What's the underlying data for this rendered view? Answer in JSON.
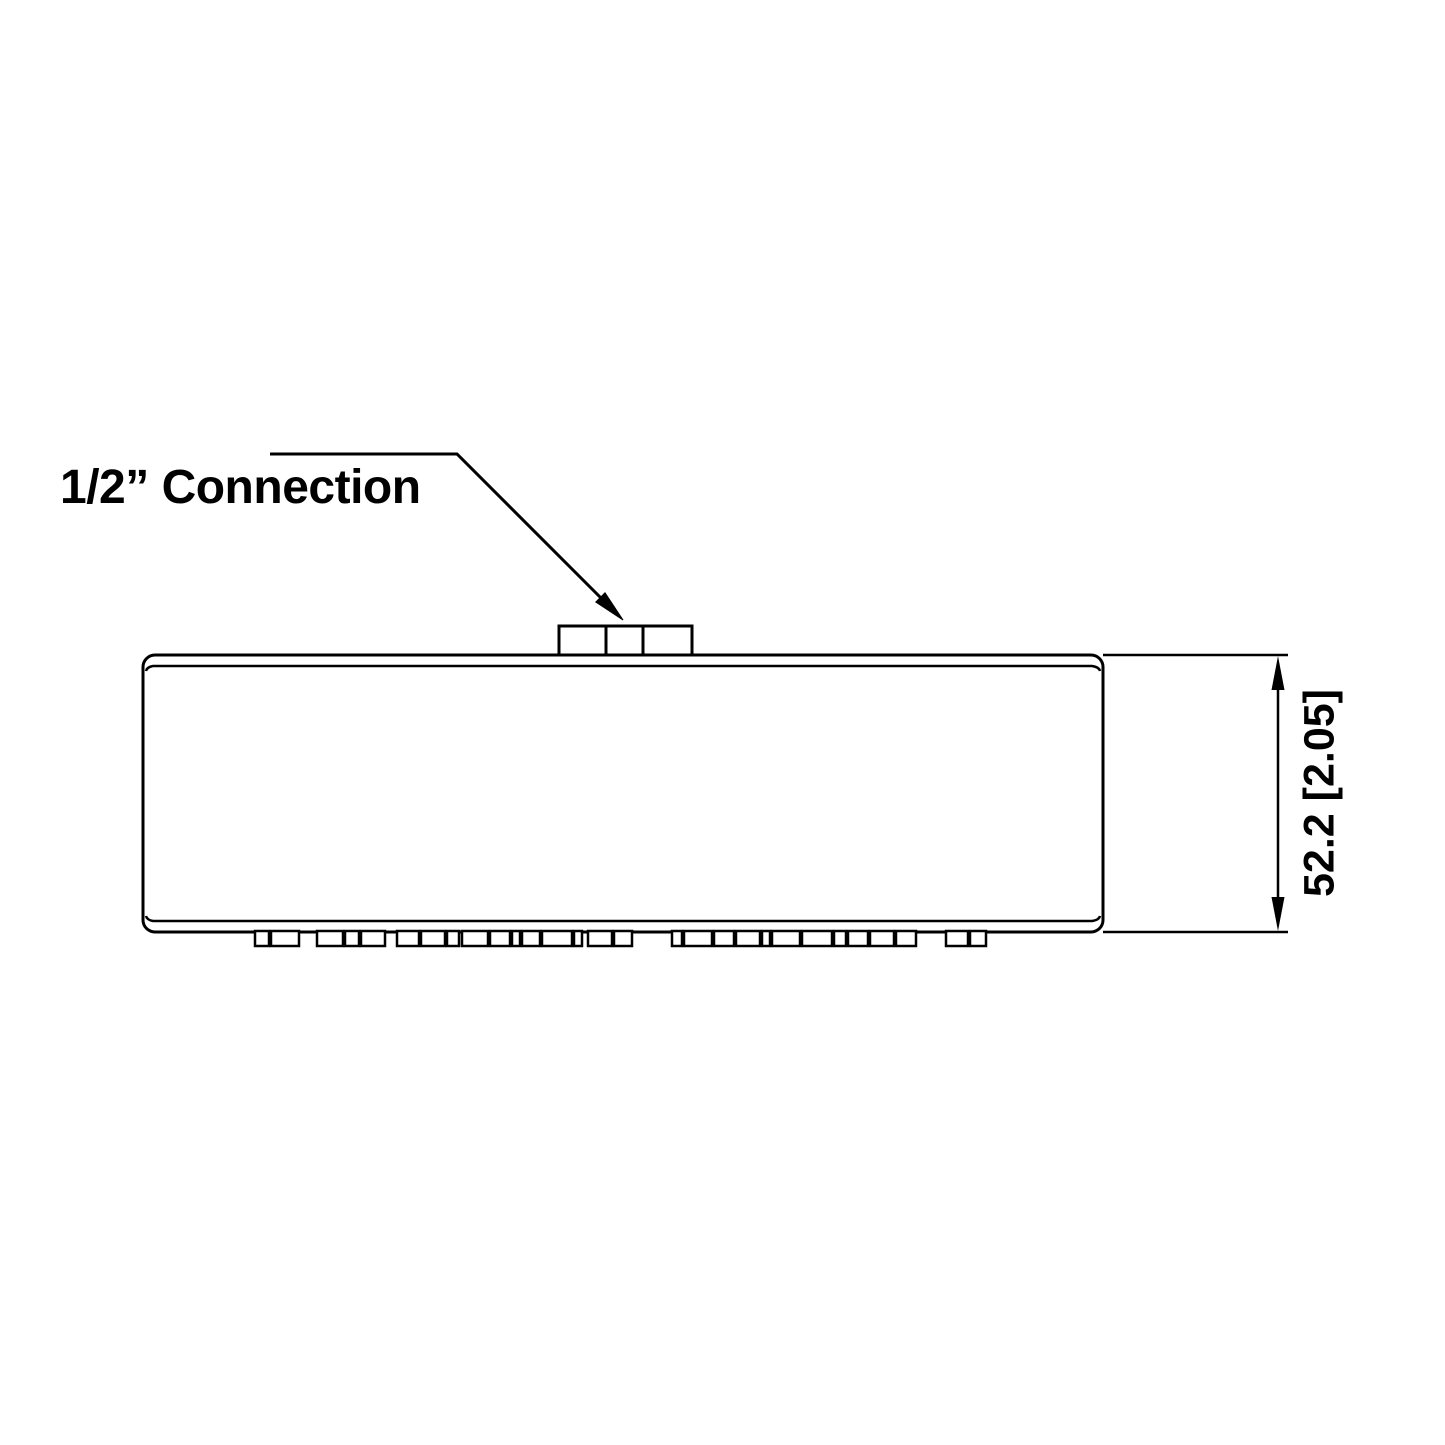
{
  "page": {
    "background": "#ffffff",
    "line_color": "#000000"
  },
  "callout": {
    "label": "1/2” Connection"
  },
  "dimension": {
    "value": "52.2 [2.05]"
  }
}
